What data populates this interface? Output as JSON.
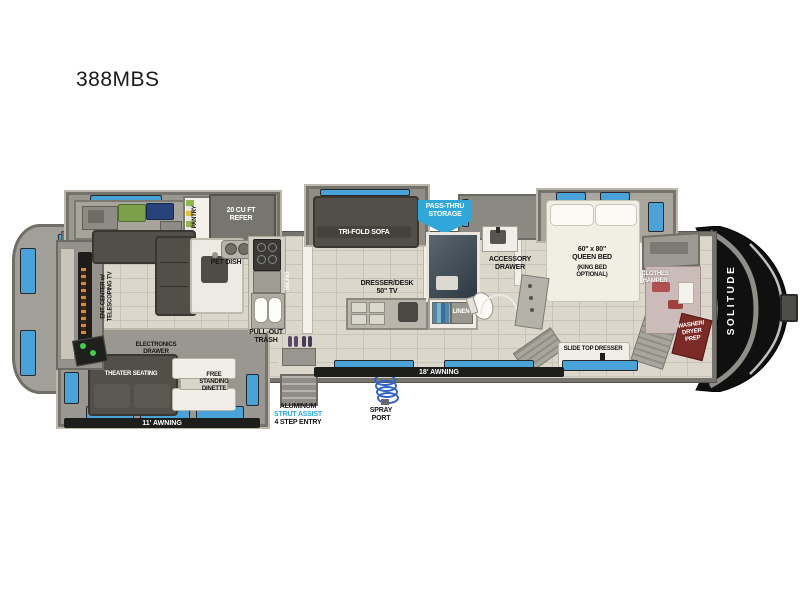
{
  "title": "388MBS",
  "brand": "SOLITUDE",
  "colors": {
    "window_blue": "#49a2d8",
    "banner_blue": "#2fa7d9",
    "accent_blue_text": "#29a8e0",
    "wall_gray": "#8f8e86",
    "floor_tan": "#dcd7cb",
    "furniture_dark": "#524f49",
    "front_cap_black": "#101010",
    "washer_red": "#7c2a26"
  },
  "rooms": {
    "kitchen": {
      "pantry": "PANTRY",
      "refer": "20 CU FT\nREFER",
      "pet_dish": "PET DISH",
      "micro": "MICRO",
      "pull_out_trash": "PULL-OUT\nTRASH"
    },
    "living": {
      "ent_center": "ENT. CENTER w/\nTELESCOPING TV",
      "electronics_drawer": "ELECTRONICS\nDRAWER",
      "theater_seating": "THEATER SEATING",
      "dinette": "FREE\nSTANDING\nDINETTE",
      "tri_fold_sofa": "TRI-FOLD SOFA"
    },
    "den": {
      "dresser_desk": "DRESSER/DESK\n50\" TV"
    },
    "bath": {
      "linen": "LINEN",
      "accessory_drawer": "ACCESSORY\nDRAWER"
    },
    "bedroom": {
      "bed": "60\" x 80\"\nQUEEN BED",
      "bed_option": "(KING BED\nOPTIONAL)",
      "clothes_hamper": "CLOTHES\nHAMPER",
      "slide_top_dresser": "SLIDE TOP DRESSER",
      "washer_dryer": "WASHER/\nDRYER\nPREP"
    },
    "exterior": {
      "pass_thru": "PASS-THRU\nSTORAGE",
      "awning_rear": "11' AWNING",
      "awning_main": "18' AWNING",
      "entry_line1": "ALUMINUM",
      "entry_line2": "STRUT ASSIST",
      "entry_line3": "4 STEP ENTRY",
      "spray_port": "SPRAY\nPORT"
    }
  }
}
